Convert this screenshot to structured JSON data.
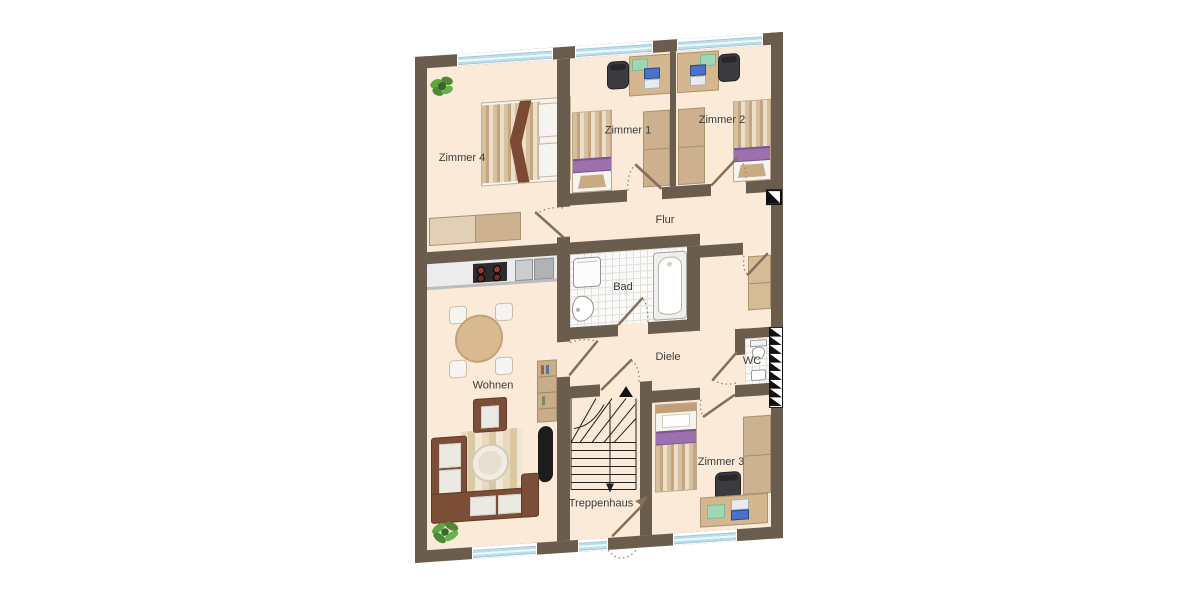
{
  "floorplan": {
    "rooms": [
      {
        "id": "zimmer-4",
        "label": "Zimmer 4"
      },
      {
        "id": "zimmer-1",
        "label": "Zimmer 1"
      },
      {
        "id": "zimmer-2",
        "label": "Zimmer 2"
      },
      {
        "id": "flur",
        "label": "Flur"
      },
      {
        "id": "bad",
        "label": "Bad"
      },
      {
        "id": "diele",
        "label": "Diele"
      },
      {
        "id": "wc",
        "label": "WC"
      },
      {
        "id": "wohnen",
        "label": "Wohnen"
      },
      {
        "id": "treppenhaus",
        "label": "Treppenhaus"
      },
      {
        "id": "zimmer-3",
        "label": "Zimmer 3"
      }
    ],
    "palette": {
      "background": "#ffffff",
      "wall": "#6b5d4e",
      "floor": "#fcead8",
      "bath_tile": "#fafafa",
      "window_glass": "#cfeaf3",
      "wood_light": "#d2b692",
      "wood_dark": "#c9ad8b",
      "bed_purple": "#9c70ad",
      "sofa_brown": "#7c4e38",
      "chair_black": "#3b3b3e",
      "laptop_blue": "#4a72c8",
      "plant_green": "#4c8a33",
      "door_swing": "#87705a",
      "stair_line": "#222222",
      "label_text": "#3a3a3a"
    }
  }
}
